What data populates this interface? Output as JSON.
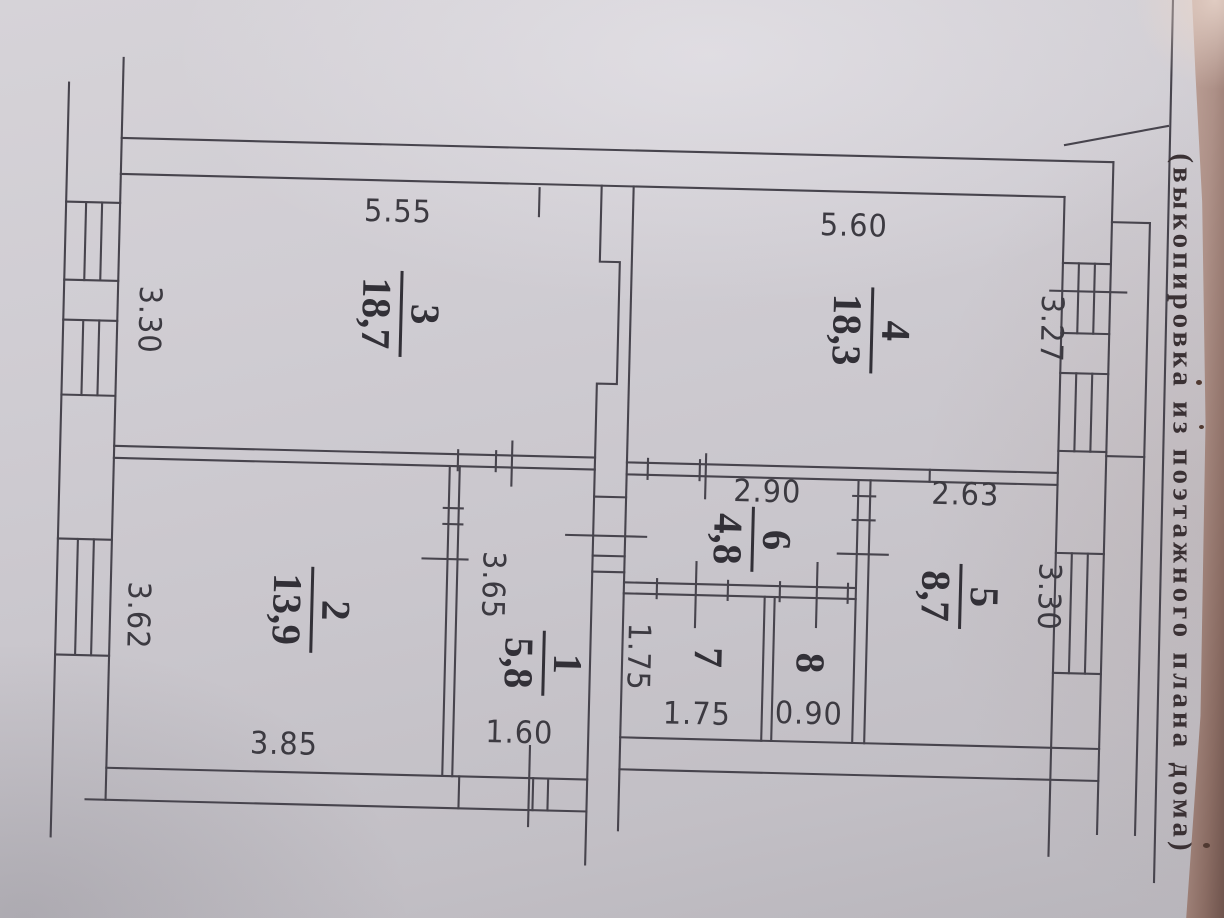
{
  "document": {
    "side_caption": "(выкопировка из поэтажного плана дома)"
  },
  "plan": {
    "rooms": [
      {
        "number": "1",
        "area": "5,8"
      },
      {
        "number": "2",
        "area": "13,9"
      },
      {
        "number": "3",
        "area": "18,7"
      },
      {
        "number": "4",
        "area": "18,3"
      },
      {
        "number": "5",
        "area": "8,7"
      },
      {
        "number": "6",
        "area": "4,8"
      },
      {
        "number": "7",
        "area": ""
      },
      {
        "number": "8",
        "area": ""
      }
    ],
    "dimensions": {
      "room3_width": "5.55",
      "room3_depth": "3.30",
      "room4_width": "5.60",
      "room4_depth": "3.27",
      "room2_width": "3.85",
      "room2_depth": "3.62",
      "room1_width": "1.60",
      "room1_depth": "3.65",
      "room6_width": "2.90",
      "room5_width": "2.63",
      "room5_depth": "3.30",
      "room7_width": "1.75",
      "room7_depth": "1.75",
      "room8_width": "0.90"
    }
  }
}
